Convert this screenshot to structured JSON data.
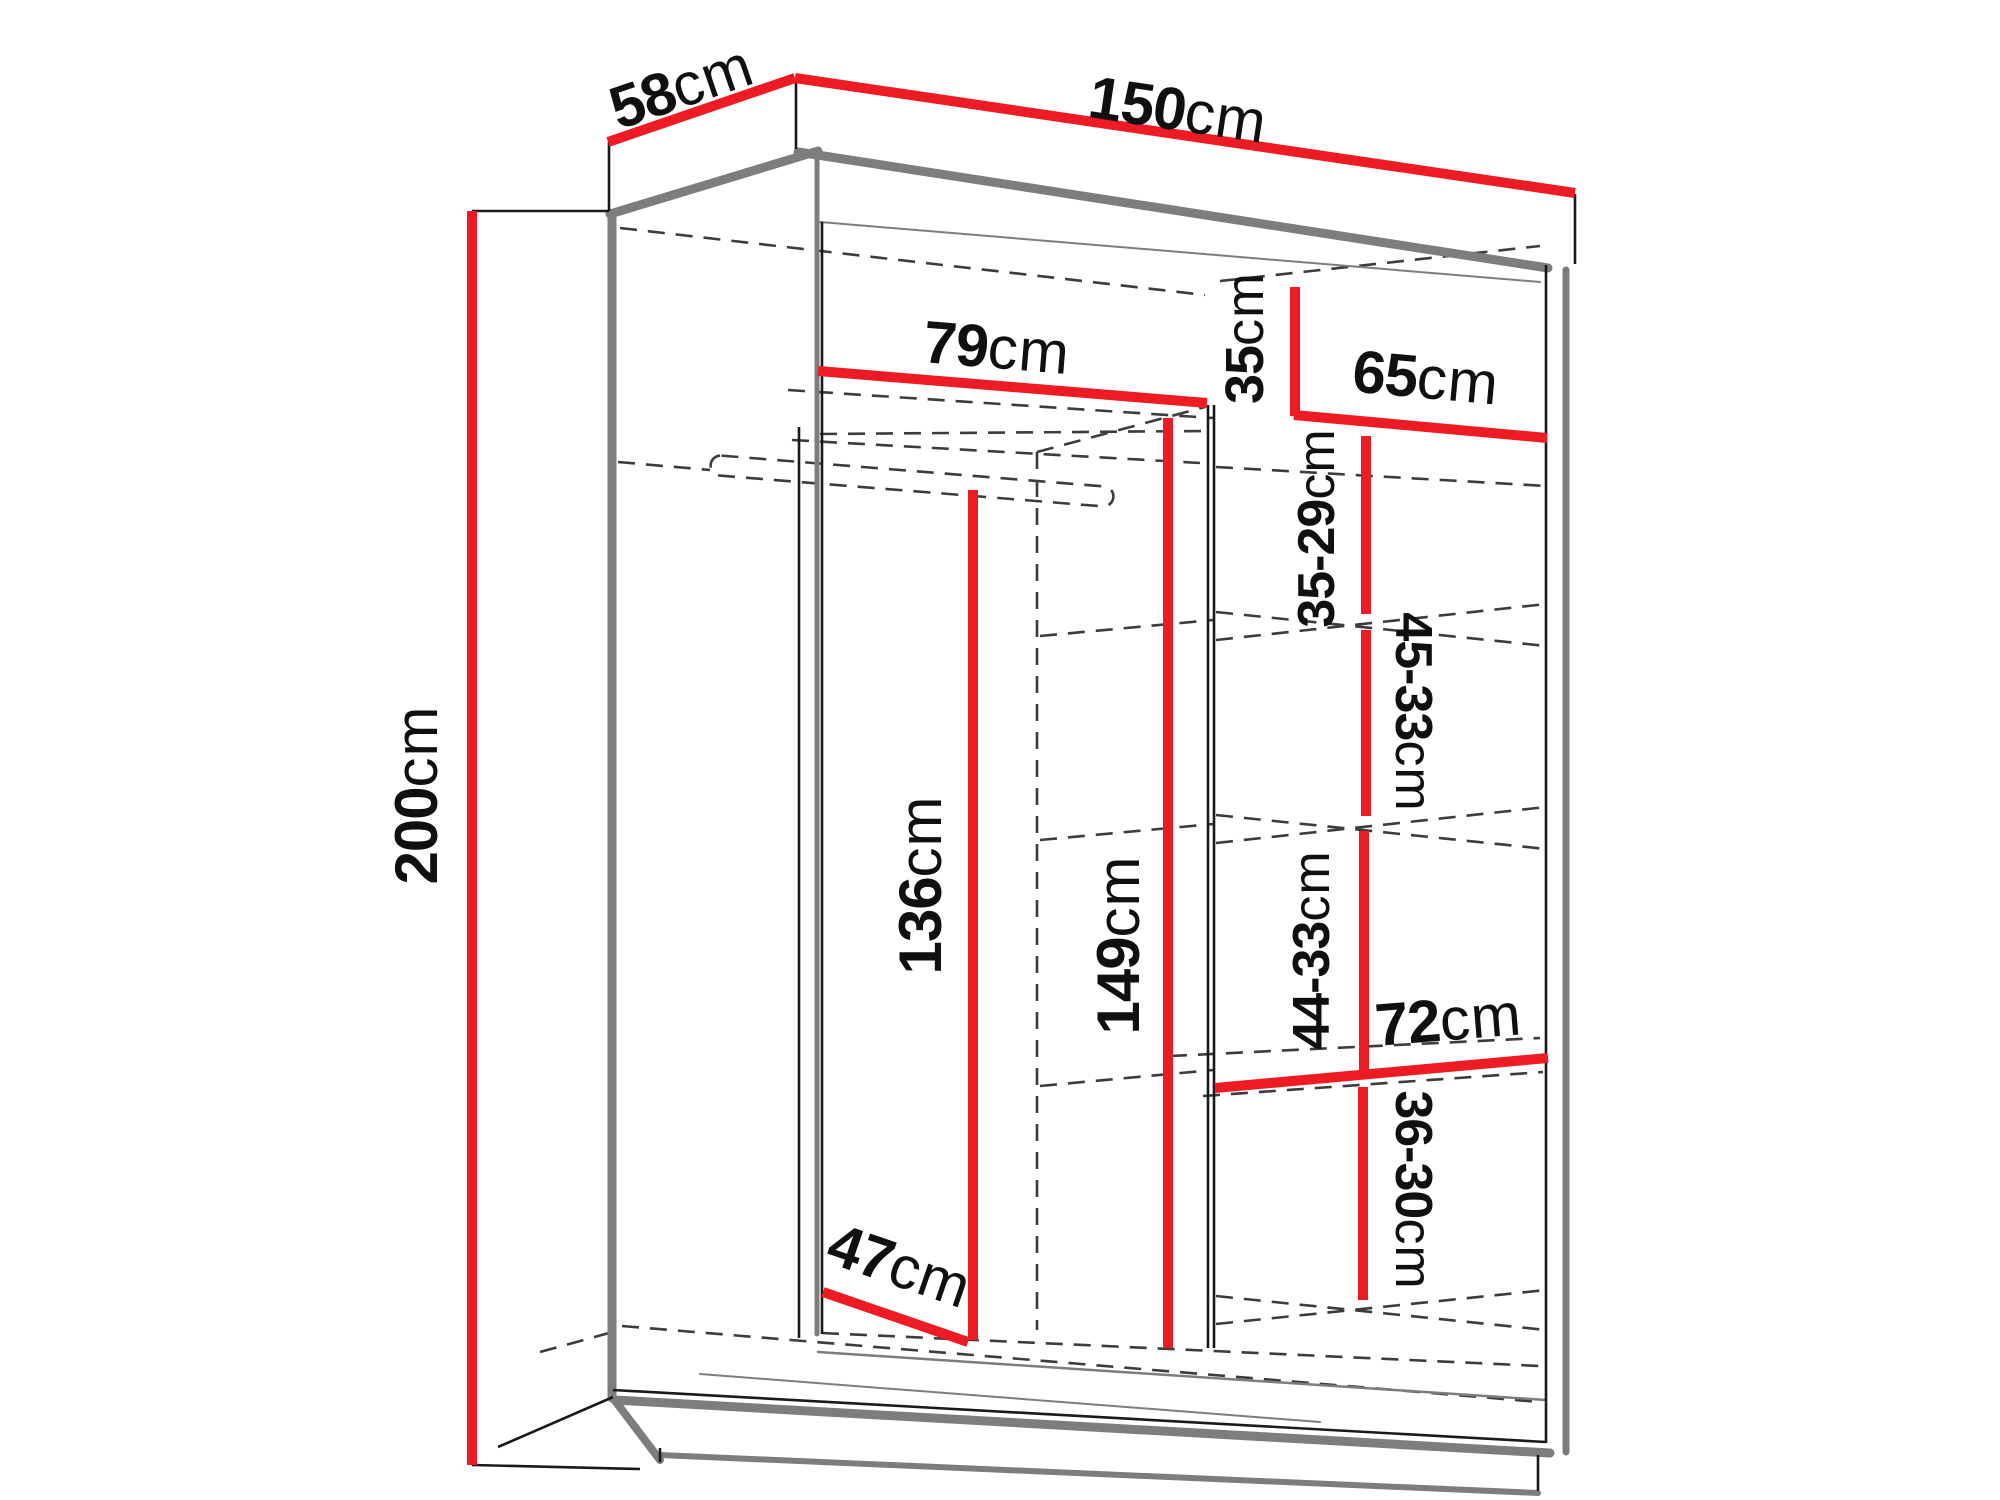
{
  "diagram": {
    "type": "furniture-dimension-diagram",
    "subject": "two-door sliding wardrobe, open front view with interior shelves and hanging rail",
    "unit": "cm",
    "colors": {
      "dimension_line": "#ed1c24",
      "structure_edge_gray": "#7d7d7d",
      "outline_black": "#1a1a1a",
      "hidden_edge_dashed": "#3c3c3c",
      "background": "#ffffff",
      "label_text": "#101010"
    },
    "dims": {
      "depth": {
        "value": "58",
        "unit": "cm",
        "meaning": "overall depth (top left)"
      },
      "width": {
        "value": "150",
        "unit": "cm",
        "meaning": "overall width (top)"
      },
      "height": {
        "value": "200",
        "unit": "cm",
        "meaning": "overall height (left)"
      },
      "left_top_width": {
        "value": "79",
        "unit": "cm",
        "meaning": "hanging section width at top shelf"
      },
      "cubby_height": {
        "value": "35",
        "unit": "cm",
        "meaning": "top right cubby height"
      },
      "right_width": {
        "value": "65",
        "unit": "cm",
        "meaning": "right shelf section width"
      },
      "gap1": {
        "value": "35-29",
        "unit": "cm",
        "meaning": "shelf spacing 1"
      },
      "gap2": {
        "value": "45-33",
        "unit": "cm",
        "meaning": "shelf spacing 2"
      },
      "gap3": {
        "value": "44-33",
        "unit": "cm",
        "meaning": "shelf spacing 3"
      },
      "bottom_shelf": {
        "value": "72",
        "unit": "cm",
        "meaning": "bottom shelf width"
      },
      "gap4": {
        "value": "36-30",
        "unit": "cm",
        "meaning": "bottom shelf spacing"
      },
      "hanging_height": {
        "value": "136",
        "unit": "cm",
        "meaning": "clear height under rail"
      },
      "interior_height": {
        "value": "149",
        "unit": "cm",
        "meaning": "interior height at divider"
      },
      "bottom_depth": {
        "value": "47",
        "unit": "cm",
        "meaning": "usable bottom depth"
      }
    }
  }
}
